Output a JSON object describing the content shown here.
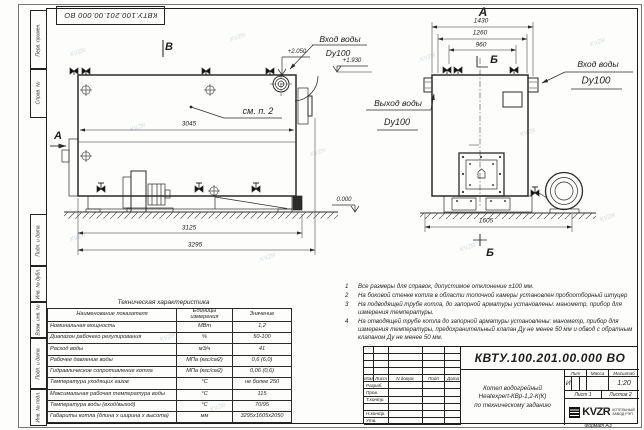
{
  "stamp_top": "КВТУ.100.201.00.000 ВО",
  "watermark": "KVZR",
  "margin": {
    "top": [
      "Перв. примен.",
      "Справ. №"
    ],
    "bottom": [
      "Подп. и дата",
      "Инв. № дубл.",
      "Взам. инв. №",
      "Подп. и дата",
      "Инв. № подл."
    ]
  },
  "drawing": {
    "side_view": {
      "view_mark": "В",
      "section_mark": "А",
      "callout": "см. п. 2",
      "dim_width_inner": "3045",
      "dim_width_frame": "3125",
      "dim_width_total": "3295",
      "elev_inlet": "+2.050",
      "elev_outlet": "+1.930",
      "elev_ground": "0.000",
      "inlet_label": "Вход воды",
      "inlet_dn": "Dy100",
      "outlet_label": "Выход воды",
      "outlet_dn": "Dy100"
    },
    "front_view": {
      "view_mark": "А",
      "section_mark_top": "Б",
      "section_mark_bottom": "Б",
      "dim_total": "1430",
      "dim_mid": "1260",
      "dim_valves": "960",
      "dim_depth": "1605",
      "inlet_label": "Вход воды",
      "inlet_dn": "Dy100"
    }
  },
  "spec_table": {
    "title": "Техническая характеристика",
    "headers": [
      "Наименование показателя",
      "Единицы измерения",
      "Значение"
    ],
    "rows": [
      [
        "Номинальная мощность",
        "МВт",
        "1,2"
      ],
      [
        "Диапазон рабочего регулирования",
        "%",
        "50-100"
      ],
      [
        "Расход воды",
        "м3/ч",
        "41"
      ],
      [
        "Рабочее давление воды",
        "МПа (кгс/см2)",
        "0,6 (6,0)"
      ],
      [
        "Гидравлическое сопротивление котла",
        "МПа (кгс/см2)",
        "0,06 (0,6)"
      ],
      [
        "Температура уходящих газов",
        "°С",
        "не более 250"
      ],
      [
        "Максимальная рабочая температура воды",
        "°С",
        "115"
      ],
      [
        "Температура воды (вход/выход)",
        "°С",
        "70/95"
      ],
      [
        "Габариты котла (длина х ширина х высота)",
        "мм",
        "3295х1605х2050"
      ]
    ]
  },
  "notes": [
    {
      "n": "1",
      "t": "Все размеры для справок, допустимое отклонение ±100 мм."
    },
    {
      "n": "2",
      "t": "На боковой стенке котла в области топочной камеры установлен пробоотборный штуцер"
    },
    {
      "n": "3",
      "t": "На подводящей трубе котла, до запорной арматуры установлены: манометр, прибор для измерения температуры."
    },
    {
      "n": "4",
      "t": "На отводящей трубе котла до запорной арматуры установлены: манометр, прибор для измерения температуры, предохранительный клапан Ду не менее 50 мм и обвод с обратным клапаном Ду не менее 50 мм."
    }
  ],
  "title_block": {
    "doc_number": "КВТУ.100.201.00.000 ВО",
    "title_lines": [
      "Котел водогрейный",
      "Heatexpert-КВр-1,2-К(К)",
      "по техническому заданию"
    ],
    "header_cells": [
      "Изм",
      "Лист",
      "N докум.",
      "Подп",
      "Дата"
    ],
    "row_labels": [
      "Разраб.",
      "Пров.",
      "Т.контр.",
      "",
      "Н.контр.",
      "Утв."
    ],
    "lit_headers": [
      "Лит",
      "Масса",
      "Масштаб"
    ],
    "lit_value": "И",
    "scale_value": "1:20",
    "sheet_label": "Лист 1",
    "sheets_label": "Листов 2",
    "logo_text": "KVZR",
    "logo_sub1": "КОТЕЛЬНЫЙ",
    "logo_sub2": "ЗАВОД РЭП",
    "format_label": "Формат А3"
  }
}
